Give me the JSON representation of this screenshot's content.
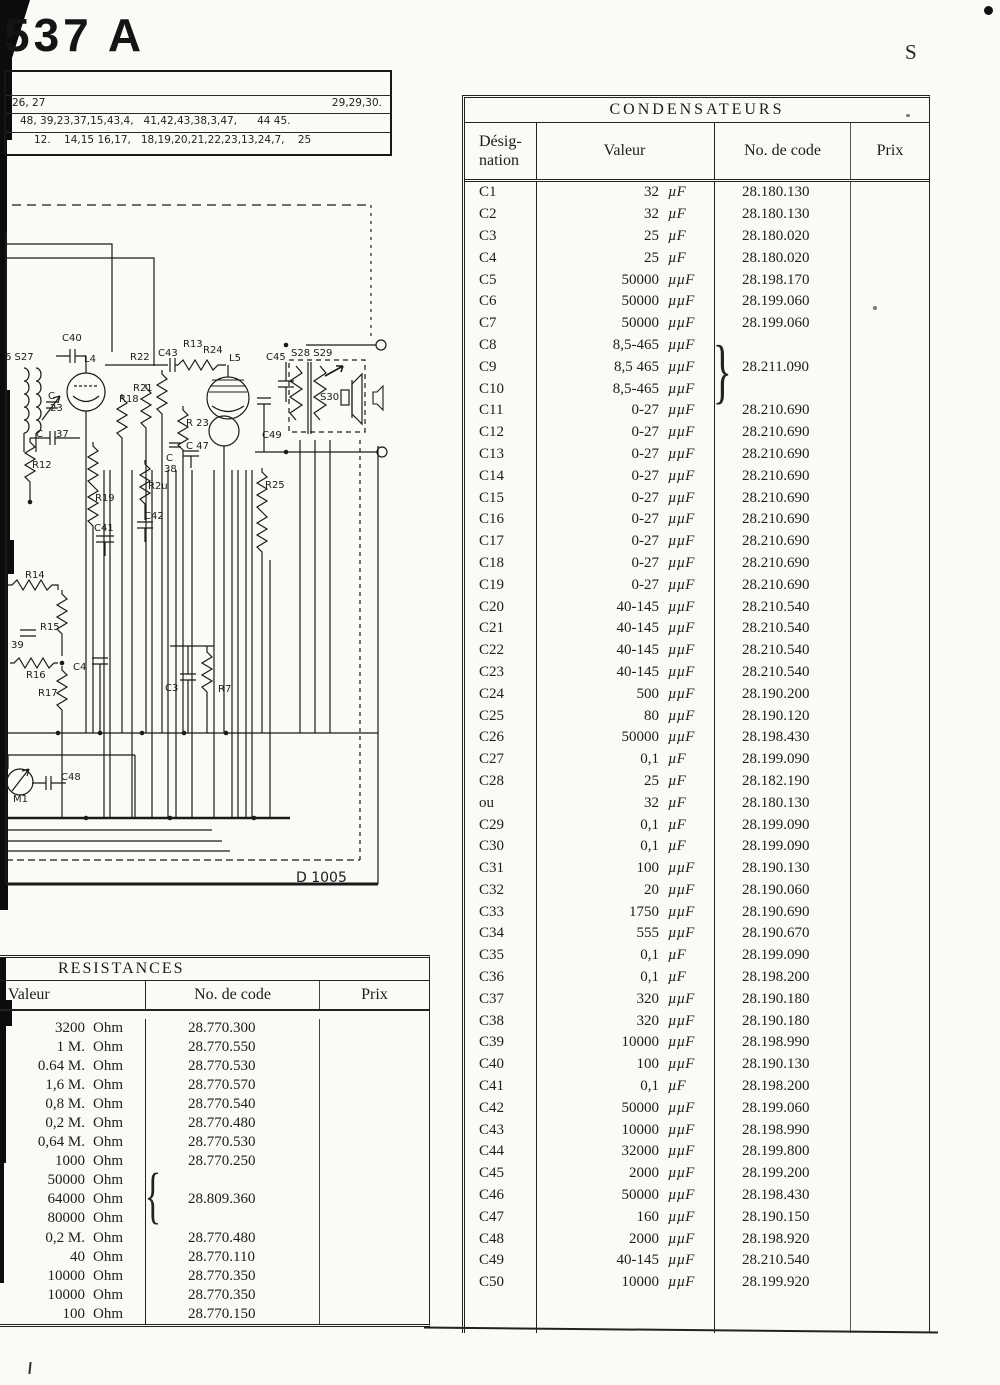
{
  "page": {
    "model": "537 A",
    "corner_letter": "S"
  },
  "top_box": {
    "row1_left": "26, 27",
    "row1_right": "29,29,30.",
    "row2": "48, 39,23,37,15,43,4,   41,42,43,38,3,47,      44 45.",
    "row3": "12.    14,15 16,17,   18,19,20,21,22,23,13,24,7,    25"
  },
  "schematic": {
    "drawing_number": "D 1005",
    "labels": [
      [
        "C40",
        62,
        341
      ],
      [
        "L4",
        84,
        362
      ],
      [
        "R22",
        130,
        360
      ],
      [
        "C43",
        158,
        356
      ],
      [
        "R13",
        183,
        347
      ],
      [
        "R24",
        203,
        353
      ],
      [
        "L5",
        229,
        361
      ],
      [
        "C45",
        266,
        360
      ],
      [
        "S28 S29",
        291,
        356
      ],
      [
        "S30",
        320,
        400
      ],
      [
        "R21",
        133,
        391
      ],
      [
        "R18",
        119,
        402
      ],
      [
        "R 23",
        186,
        426
      ],
      [
        "C 47",
        186,
        449
      ],
      [
        "C",
        166,
        461
      ],
      [
        "38",
        164,
        472
      ],
      [
        "6 S27",
        5,
        360
      ],
      [
        "C",
        48,
        399
      ],
      [
        "23",
        50,
        411
      ],
      [
        "C",
        36,
        437
      ],
      [
        "37",
        56,
        437
      ],
      [
        "R12",
        32,
        468
      ],
      [
        "R19",
        95,
        501
      ],
      [
        "R2u",
        148,
        489
      ],
      [
        "C42",
        144,
        519
      ],
      [
        "C41",
        94,
        531
      ],
      [
        "C49",
        262,
        438
      ],
      [
        "R25",
        265,
        488
      ],
      [
        "R14",
        25,
        578
      ],
      [
        "R15",
        40,
        630
      ],
      [
        "39",
        11,
        648
      ],
      [
        "R16",
        26,
        678
      ],
      [
        "R17",
        38,
        696
      ],
      [
        "C4",
        73,
        670
      ],
      [
        "C3",
        165,
        691
      ],
      [
        "R7",
        218,
        692
      ],
      [
        "M1",
        13,
        802
      ],
      [
        "C48",
        61,
        780
      ]
    ]
  },
  "condensateurs": {
    "title": "CONDENSATEURS",
    "col_designation_line1": "Désig-",
    "col_designation_line2": "nation",
    "col_valeur": "Valeur",
    "col_code": "No. de code",
    "col_prix": "Prix",
    "brace": "}",
    "rows": [
      [
        "C1",
        "32",
        "µF",
        "28.180.130"
      ],
      [
        "C2",
        "32",
        "µF",
        "28.180.130"
      ],
      [
        "C3",
        "25",
        "µF",
        "28.180.020"
      ],
      [
        "C4",
        "25",
        "µF",
        "28.180.020"
      ],
      [
        "C5",
        "50000",
        "µµF",
        "28.198.170"
      ],
      [
        "C6",
        "50000",
        "µµF",
        "28.199.060"
      ],
      [
        "C7",
        "50000",
        "µµF",
        "28.199.060"
      ],
      [
        "C8",
        "8,5-465",
        "µµF",
        ""
      ],
      [
        "C9",
        "8,5 465",
        "µµF",
        "28.211.090"
      ],
      [
        "C10",
        "8,5-465",
        "µµF",
        ""
      ],
      [
        "C11",
        "0-27",
        "µµF",
        "28.210.690"
      ],
      [
        "C12",
        "0-27",
        "µµF",
        "28.210.690"
      ],
      [
        "C13",
        "0-27",
        "µµF",
        "28.210.690"
      ],
      [
        "C14",
        "0-27",
        "µµF",
        "28.210.690"
      ],
      [
        "C15",
        "0-27",
        "µµF",
        "28.210.690"
      ],
      [
        "C16",
        "0-27",
        "µµF",
        "28.210.690"
      ],
      [
        "C17",
        "0-27",
        "µµF",
        "28.210.690"
      ],
      [
        "C18",
        "0-27",
        "µµF",
        "28.210.690"
      ],
      [
        "C19",
        "0-27",
        "µµF",
        "28.210.690"
      ],
      [
        "C20",
        "40-145",
        "µµF",
        "28.210.540"
      ],
      [
        "C21",
        "40-145",
        "µµF",
        "28.210.540"
      ],
      [
        "C22",
        "40-145",
        "µµF",
        "28.210.540"
      ],
      [
        "C23",
        "40-145",
        "µµF",
        "28.210.540"
      ],
      [
        "C24",
        "500",
        "µµF",
        "28.190.200"
      ],
      [
        "C25",
        "80",
        "µµF",
        "28.190.120"
      ],
      [
        "C26",
        "50000",
        "µµF",
        "28.198.430"
      ],
      [
        "C27",
        "0,1",
        "µF",
        "28.199.090"
      ],
      [
        "C28",
        "25",
        "µF",
        "28.182.190"
      ],
      [
        "ou",
        "32",
        "µF",
        "28.180.130"
      ],
      [
        "C29",
        "0,1",
        "µF",
        "28.199.090"
      ],
      [
        "C30",
        "0,1",
        "µF",
        "28.199.090"
      ],
      [
        "C31",
        "100",
        "µµF",
        "28.190.130"
      ],
      [
        "C32",
        "20",
        "µµF",
        "28.190.060"
      ],
      [
        "C33",
        "1750",
        "µµF",
        "28.190.690"
      ],
      [
        "C34",
        "555",
        "µµF",
        "28.190.670"
      ],
      [
        "C35",
        "0,1",
        "µF",
        "28.199.090"
      ],
      [
        "C36",
        "0,1",
        "µF",
        "28.198.200"
      ],
      [
        "C37",
        "320",
        "µµF",
        "28.190.180"
      ],
      [
        "C38",
        "320",
        "µµF",
        "28.190.180"
      ],
      [
        "C39",
        "10000",
        "µµF",
        "28.198.990"
      ],
      [
        "C40",
        "100",
        "µµF",
        "28.190.130"
      ],
      [
        "C41",
        "0,1",
        "µF",
        "28.198.200"
      ],
      [
        "C42",
        "50000",
        "µµF",
        "28.199.060"
      ],
      [
        "C43",
        "10000",
        "µµF",
        "28.198.990"
      ],
      [
        "C44",
        "32000",
        "µµF",
        "28.199.800"
      ],
      [
        "C45",
        "2000",
        "µµF",
        "28.199.200"
      ],
      [
        "C46",
        "50000",
        "µµF",
        "28.198.430"
      ],
      [
        "C47",
        "160",
        "µµF",
        "28.190.150"
      ],
      [
        "C48",
        "2000",
        "µµF",
        "28.198.920"
      ],
      [
        "C49",
        "40-145",
        "µµF",
        "28.210.540"
      ],
      [
        "C50",
        "10000",
        "µµF",
        "28.199.920"
      ]
    ]
  },
  "resistances": {
    "title": "RESISTANCES",
    "col_valeur": "Valeur",
    "col_code": "No. de code",
    "col_prix": "Prix",
    "brace": "{",
    "rows": [
      [
        "3200",
        "Ohm",
        "28.770.300"
      ],
      [
        "1 M.",
        "Ohm",
        "28.770.550"
      ],
      [
        "0.64 M.",
        "Ohm",
        "28.770.530"
      ],
      [
        "1,6 M.",
        "Ohm",
        "28.770.570"
      ],
      [
        "0,8 M.",
        "Ohm",
        "28.770.540"
      ],
      [
        "0,2 M.",
        "Ohm",
        "28.770.480"
      ],
      [
        "0,64 M.",
        "Ohm",
        "28.770.530"
      ],
      [
        "1000",
        "Ohm",
        "28.770.250"
      ],
      [
        "50000",
        "Ohm",
        ""
      ],
      [
        "64000",
        "Ohm",
        "28.809.360"
      ],
      [
        "80000",
        "Ohm",
        ""
      ],
      [
        "0,2 M.",
        "Ohm",
        "28.770.480"
      ],
      [
        "40",
        "Ohm",
        "28.770.110"
      ],
      [
        "10000",
        "Ohm",
        "28.770.350"
      ],
      [
        "10000",
        "Ohm",
        "28.770.350"
      ],
      [
        "100",
        "Ohm",
        "28.770.150"
      ]
    ]
  }
}
